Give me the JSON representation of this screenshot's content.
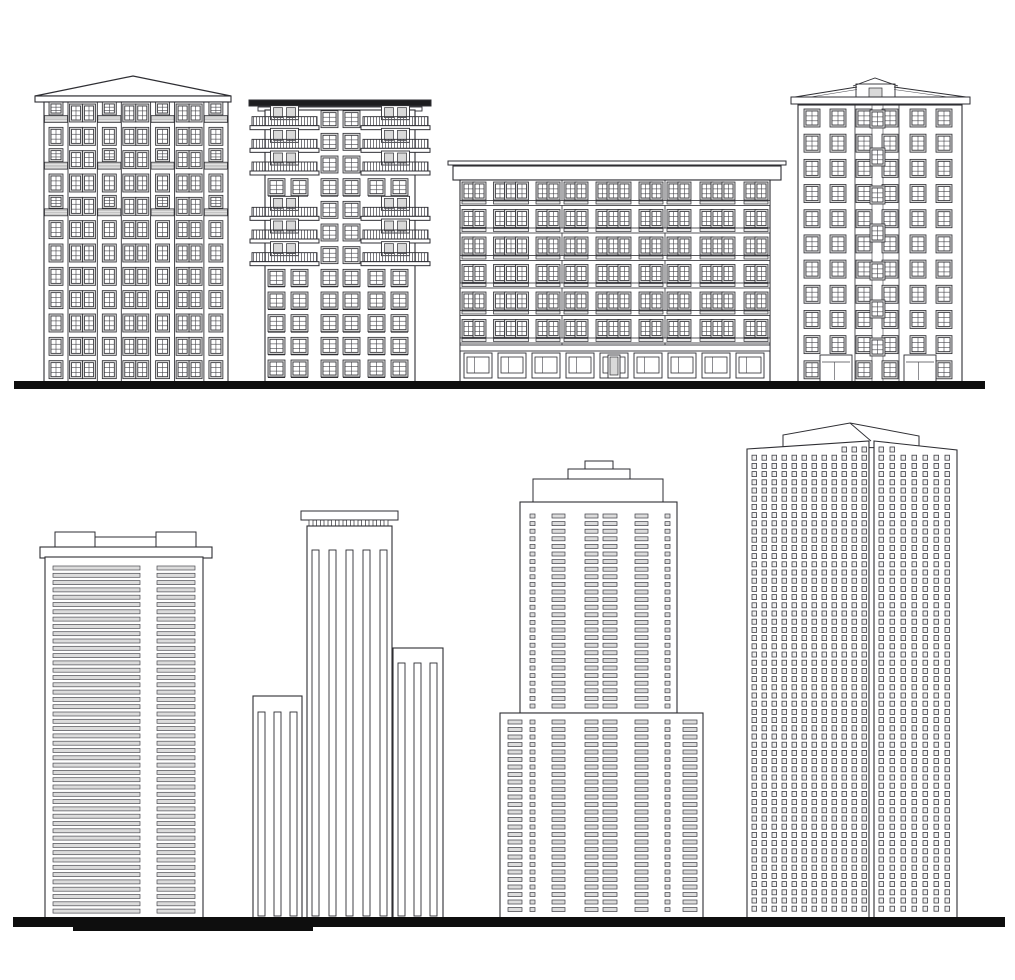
{
  "scene": {
    "width": 1015,
    "height": 980,
    "background": "#ffffff",
    "ink": "#2e2e33",
    "ink_soft": "#44444a",
    "window_fill": "#d9d9d9",
    "cell_fill": "#dcdcdc",
    "tiny_fill": "#efefef",
    "band_fill": "#c4c4c4",
    "ground_color": "#0e0e0e",
    "grounds": [
      {
        "name": "ground-line-top",
        "x": 14,
        "y": 381,
        "w": 971,
        "h": 8
      },
      {
        "name": "ground-line-bottom",
        "x": 13,
        "y": 917,
        "w": 992,
        "h": 10
      },
      {
        "name": "ground-line-bottom-accent",
        "x": 73,
        "y": 927,
        "w": 240,
        "h": 4
      }
    ],
    "buildings": [
      {
        "name": "building-1-classic-apartment",
        "type": "hip_apartment",
        "x": 44,
        "top": 102,
        "w": 184,
        "bottom": 382,
        "roof": {
          "peak": [
            133,
            76
          ],
          "tri": [
            [
              35,
              96
            ],
            [
              231,
              96
            ]
          ],
          "eave": [
            35,
            96,
            196,
            6
          ]
        },
        "rows": 12,
        "sections": [
          {
            "kind": "bay",
            "w": 24
          },
          {
            "kind": "pair",
            "w": 29.3
          },
          {
            "kind": "bay",
            "w": 24
          },
          {
            "kind": "pair",
            "w": 29.3
          },
          {
            "kind": "bay",
            "w": 24
          },
          {
            "kind": "pair",
            "w": 29.3
          },
          {
            "kind": "bay",
            "w": 24
          }
        ],
        "balcony_rows": [
          0,
          2,
          4
        ],
        "win": {
          "w": 10,
          "h": 14,
          "short_h": 9
        }
      },
      {
        "name": "building-2-balcony-tower",
        "type": "balcony_tower",
        "x": 265,
        "top": 110,
        "w": 150,
        "bottom": 382,
        "roof_slab": [
          249,
          100,
          182,
          6
        ],
        "roof_plate": [
          258,
          107,
          164,
          4
        ],
        "rows": 12,
        "balcony_rows": [
          0,
          1,
          2,
          4,
          5,
          6
        ],
        "balconies": [
          {
            "x": 252,
            "w": 65
          },
          {
            "x": 363,
            "w": 65
          }
        ],
        "window_cols": [
          270,
          293,
          323,
          345,
          370,
          393
        ],
        "center_cols": [
          323,
          345
        ],
        "win": {
          "w": 13,
          "h": 13
        }
      },
      {
        "name": "building-3-block-of-flats",
        "type": "block_flats",
        "x": 460,
        "top": 180,
        "w": 310,
        "bottom": 382,
        "cornice": {
          "bar": [
            448,
            161,
            338,
            4
          ],
          "slab": [
            453,
            166,
            328,
            14
          ]
        },
        "floors": 6,
        "ground_top": 345,
        "section_xs": [
          460,
          562,
          665,
          770
        ],
        "groups": [
          2,
          3,
          2
        ],
        "win": {
          "w": 9,
          "h": 14,
          "gap": 2
        },
        "storefronts": {
          "count": 9,
          "door_index": 4,
          "y": 353,
          "h": 25
        }
      },
      {
        "name": "building-4-gable-apartment",
        "type": "gable_apartment",
        "x": 798,
        "top": 105,
        "w": 164,
        "bottom": 382,
        "cornice": [
          791,
          97,
          179,
          7
        ],
        "slopes": [
          [
            795,
            97,
            857,
            87
          ],
          [
            894,
            87,
            966,
            97
          ]
        ],
        "attic": {
          "box": [
            856,
            84,
            39,
            14
          ],
          "peakline": [
            [
              853,
              86
            ],
            [
              875,
              78
            ],
            [
              898,
              86
            ]
          ],
          "win": [
            869,
            88,
            13,
            9
          ]
        },
        "rows": 11,
        "cols": [
          806,
          832,
          858,
          884,
          912,
          938
        ],
        "win": {
          "w": 12,
          "h": 14
        },
        "bay": {
          "x1": 855,
          "x2": 899
        },
        "stair": {
          "x": 872,
          "w": 11,
          "ys": [
            112,
            150,
            188,
            226,
            264,
            302,
            340
          ],
          "h": 14
        },
        "ground_boxes": [
          [
            820,
            355,
            32,
            27
          ],
          [
            904,
            355,
            32,
            27
          ]
        ],
        "skip_last_row_cols": [
          1,
          4
        ]
      },
      {
        "name": "building-5-louver-tower",
        "type": "louver_tower",
        "x": 45,
        "top": 557,
        "w": 158,
        "bottom": 918,
        "cap": {
          "plate": [
            63,
            537,
            115,
            11
          ],
          "blocks": [
            [
              55,
              532,
              40,
              16
            ],
            [
              156,
              532,
              40,
              16
            ]
          ],
          "slab": [
            40,
            547,
            172,
            11
          ]
        },
        "strip_cols": [
          [
            53,
            87
          ],
          [
            157,
            38
          ]
        ],
        "strips": {
          "top": 566,
          "h": 4,
          "step": 7.3
        }
      },
      {
        "name": "building-6-pilaster-towers",
        "type": "pilaster_towers",
        "bottom": 918,
        "stripe_w": 7,
        "towers": [
          {
            "x": 253,
            "top": 696,
            "w": 49,
            "stripe_xs": [
              258,
              274,
              290
            ],
            "stripe_top": 712
          },
          {
            "x": 307,
            "top": 526,
            "w": 85,
            "stripe_xs": [
              312,
              329,
              346,
              363,
              380
            ],
            "stripe_top": 550,
            "cap": {
              "slab": [
                301,
                511,
                97,
                9
              ],
              "dentil_y": 520,
              "dentil_h": 6,
              "dentil_count": 11,
              "dentil_x0": 309,
              "dentil_step": 7.5,
              "dentil_w": 4
            }
          },
          {
            "x": 393,
            "top": 648,
            "w": 50,
            "stripe_xs": [
              398,
              414,
              430
            ],
            "stripe_top": 663
          }
        ]
      },
      {
        "name": "building-7-stepped-tower",
        "type": "stepped_tower",
        "upper": {
          "x": 520,
          "w": 157,
          "top": 502
        },
        "base": {
          "x": 500,
          "w": 203,
          "top": 713
        },
        "bottom": 918,
        "caps": [
          [
            585,
            461,
            28,
            8
          ],
          [
            568,
            469,
            62,
            10
          ],
          [
            533,
            479,
            130,
            23
          ]
        ],
        "upper_cols": [
          [
            530,
            5
          ],
          [
            552,
            13
          ],
          [
            585,
            13
          ],
          [
            603,
            14
          ],
          [
            635,
            13
          ],
          [
            665,
            5
          ]
        ],
        "base_cols": [
          [
            508,
            14
          ],
          [
            530,
            5
          ],
          [
            552,
            13
          ],
          [
            585,
            13
          ],
          [
            603,
            14
          ],
          [
            635,
            13
          ],
          [
            665,
            5
          ],
          [
            683,
            14
          ]
        ],
        "upper_rows": {
          "start": 514,
          "step": 7.6,
          "count": 26
        },
        "base_rows": {
          "start": 720,
          "step": 7.5,
          "count": 26
        },
        "cell_h": 4
      },
      {
        "name": "building-8-perspective-tower",
        "type": "perspective_tower",
        "bottom": 918,
        "cap": [
          [
            783,
            447
          ],
          [
            783,
            435
          ],
          [
            850,
            423
          ],
          [
            919,
            436
          ],
          [
            919,
            448
          ]
        ],
        "ridge": [
          [
            850,
            423
          ],
          [
            871,
            441
          ]
        ],
        "faces": [
          {
            "pts": [
              [
                747,
                449
              ],
              [
                869,
                441
              ],
              [
                869,
                918
              ],
              [
                747,
                918
              ]
            ],
            "top": [
              [
                747,
                449
              ],
              [
                869,
                441
              ]
            ],
            "col_x0": 752,
            "col_step": 10,
            "cols": 12
          },
          {
            "pts": [
              [
                874,
                441
              ],
              [
                957,
                450
              ],
              [
                957,
                918
              ],
              [
                874,
                918
              ]
            ],
            "top": [
              [
                874,
                441
              ],
              [
                957,
                450
              ]
            ],
            "col_x0": 879,
            "col_step": 11,
            "cols": 7
          }
        ],
        "rows": {
          "start": 447,
          "step": 8.2,
          "count": 58
        },
        "win": {
          "w": 4.5,
          "h": 5
        }
      }
    ]
  }
}
